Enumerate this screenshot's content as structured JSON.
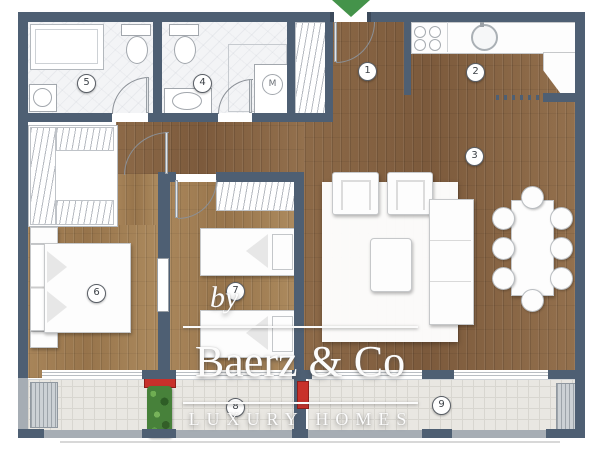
{
  "watermark": {
    "prefix": "by",
    "brand": "Baerz & Co",
    "tagline": "LUXURY HOMES"
  },
  "room_labels": [
    {
      "number": "1"
    },
    {
      "number": "2"
    },
    {
      "number": "3"
    },
    {
      "number": "4"
    },
    {
      "number": "5"
    },
    {
      "number": "6"
    },
    {
      "number": "7"
    },
    {
      "number": "8"
    },
    {
      "number": "9"
    }
  ],
  "appliances": {
    "washing_machine_label": "M"
  },
  "icons": {
    "entrance_marker": "green-down-arrow",
    "wardrobe_fill": "hanging-clothes-hatch"
  },
  "colors": {
    "wall": "#4e5f73",
    "wood_dark": "#8a6544",
    "wood_light": "#a58257",
    "marble": "#f3f4f6",
    "balcony_tile": "#e9e7e2",
    "accent_red": "#c8312b",
    "plant_green": "#47813a",
    "arrow_green": "#44934a",
    "watermark_white": "#fcfcfc"
  }
}
